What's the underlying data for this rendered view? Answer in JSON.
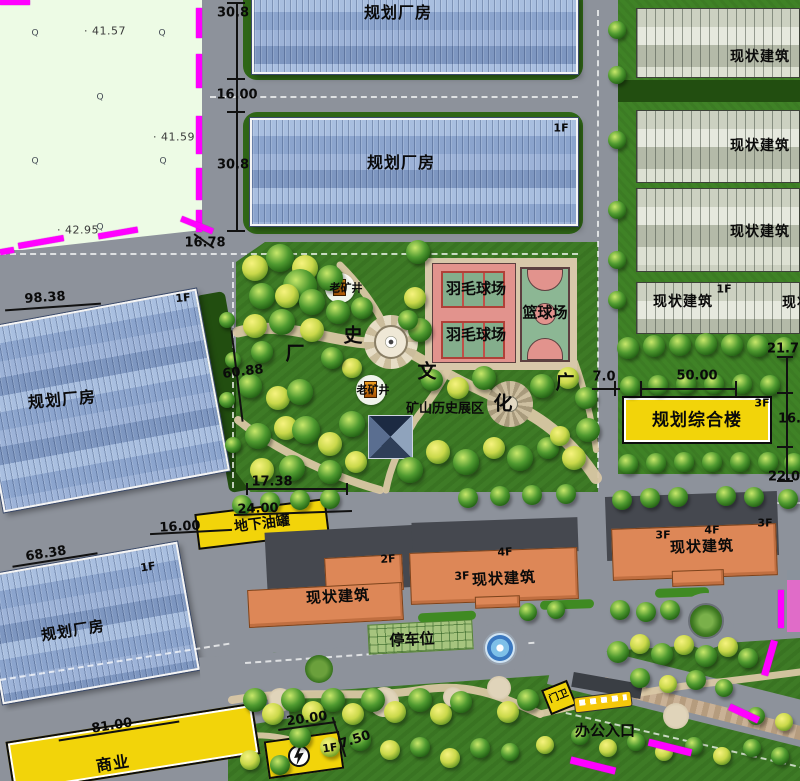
{
  "colors": {
    "boundary_magenta": "#ff00ff",
    "planned_factory_blue": "#8fa8cf",
    "existing_building_stripe": "#cdd2c2",
    "existing_building_orange": "#dd8757",
    "highlight_yellow": "#f2d40a",
    "park_green": "#3e7b26",
    "field_green": "#edfbe5",
    "road_gray": "#8d929b",
    "court_pink": "#e2938d",
    "court_green": "#84ae8c",
    "path_tan": "#d9c7a4"
  },
  "building_labels": [
    {
      "t": "规划厂房",
      "x": 398,
      "y": 13,
      "fs": 16
    },
    {
      "t": "规划厂房",
      "x": 401,
      "y": 163,
      "fs": 16
    },
    {
      "t": "规划厂房",
      "x": 62,
      "y": 400,
      "fs": 16,
      "r": -5
    },
    {
      "t": "规划厂房",
      "x": 73,
      "y": 631,
      "fs": 15,
      "r": -9
    },
    {
      "t": "现状建筑",
      "x": 760,
      "y": 57,
      "fs": 14
    },
    {
      "t": "现状建筑",
      "x": 760,
      "y": 146,
      "fs": 14
    },
    {
      "t": "现状建筑",
      "x": 760,
      "y": 232,
      "fs": 14
    },
    {
      "t": "现状建筑",
      "x": 683,
      "y": 302,
      "fs": 14
    },
    {
      "t": "现状建筑",
      "x": 812,
      "y": 303,
      "fs": 14
    },
    {
      "t": "规划综合楼",
      "x": 697,
      "y": 421,
      "fs": 17
    },
    {
      "t": "现状建筑",
      "x": 338,
      "y": 597,
      "fs": 15,
      "r": -3
    },
    {
      "t": "现状建筑",
      "x": 504,
      "y": 579,
      "fs": 15,
      "r": -3
    },
    {
      "t": "现状建筑",
      "x": 702,
      "y": 547,
      "fs": 15,
      "r": -2
    },
    {
      "t": "商业",
      "x": 113,
      "y": 764,
      "fs": 16,
      "r": -9
    }
  ],
  "floor_tags": [
    {
      "t": "1F",
      "x": 561,
      "y": 128
    },
    {
      "t": "1F",
      "x": 183,
      "y": 298,
      "r": -5
    },
    {
      "t": "1F",
      "x": 148,
      "y": 567,
      "r": -9
    },
    {
      "t": "1F",
      "x": 724,
      "y": 289
    },
    {
      "t": "3F",
      "x": 762,
      "y": 403
    },
    {
      "t": "2F",
      "x": 388,
      "y": 559,
      "r": -3
    },
    {
      "t": "3F",
      "x": 462,
      "y": 576,
      "r": -3
    },
    {
      "t": "4F",
      "x": 505,
      "y": 552,
      "r": -3
    },
    {
      "t": "3F",
      "x": 663,
      "y": 535
    },
    {
      "t": "4F",
      "x": 712,
      "y": 530
    },
    {
      "t": "3F",
      "x": 765,
      "y": 523
    },
    {
      "t": "1F",
      "x": 330,
      "y": 748,
      "r": -8
    }
  ],
  "dimension_labels": [
    {
      "t": "30.8",
      "x": 233,
      "y": 13
    },
    {
      "t": "16.00",
      "x": 237,
      "y": 95
    },
    {
      "t": "30.8",
      "x": 233,
      "y": 165
    },
    {
      "t": "16.78",
      "x": 205,
      "y": 243
    },
    {
      "t": "98.38",
      "x": 45,
      "y": 298,
      "r": -4
    },
    {
      "t": "60.88",
      "x": 243,
      "y": 372,
      "r": -7
    },
    {
      "t": "68.38",
      "x": 46,
      "y": 554,
      "r": -9
    },
    {
      "t": "81.00",
      "x": 112,
      "y": 726,
      "r": -9
    },
    {
      "t": "17.38",
      "x": 272,
      "y": 482
    },
    {
      "t": "24.00",
      "x": 258,
      "y": 509,
      "r": -2
    },
    {
      "t": "16.00",
      "x": 180,
      "y": 527,
      "r": -3
    },
    {
      "t": "7.0",
      "x": 604,
      "y": 377
    },
    {
      "t": "50.00",
      "x": 697,
      "y": 376
    },
    {
      "t": "21.7",
      "x": 783,
      "y": 349
    },
    {
      "t": "16.0",
      "x": 794,
      "y": 419
    },
    {
      "t": "22.0",
      "x": 784,
      "y": 477
    },
    {
      "t": "20.00",
      "x": 307,
      "y": 719,
      "r": -8
    },
    {
      "t": "7.50",
      "x": 355,
      "y": 740,
      "r": -18
    }
  ],
  "elevation_labels": [
    {
      "t": "· 41.57",
      "x": 105,
      "y": 31
    },
    {
      "t": "· 41.59",
      "x": 174,
      "y": 137
    },
    {
      "t": "· 42.95",
      "x": 78,
      "y": 230
    }
  ],
  "feature_labels": [
    {
      "t": "羽毛球场",
      "x": 476,
      "y": 289,
      "fs": 15
    },
    {
      "t": "羽毛球场",
      "x": 476,
      "y": 335,
      "fs": 15
    },
    {
      "t": "篮球场",
      "x": 545,
      "y": 313,
      "fs": 15
    },
    {
      "t": "地下油罐",
      "x": 262,
      "y": 524,
      "fs": 14,
      "r": -7
    },
    {
      "t": "停车位",
      "x": 412,
      "y": 640,
      "fs": 15,
      "r": -3
    },
    {
      "t": "办公入口",
      "x": 605,
      "y": 731,
      "fs": 15
    },
    {
      "t": "门卫",
      "x": 559,
      "y": 697,
      "fs": 10,
      "r": -22
    },
    {
      "t": "老矿井",
      "x": 346,
      "y": 288,
      "fs": 11
    },
    {
      "t": "老矿井",
      "x": 373,
      "y": 390,
      "fs": 11
    },
    {
      "t": "矿山历史展区",
      "x": 445,
      "y": 409,
      "fs": 13
    }
  ],
  "scattered_characters": [
    {
      "t": "厂",
      "x": 295,
      "y": 354
    },
    {
      "t": "史",
      "x": 353,
      "y": 336
    },
    {
      "t": "文",
      "x": 427,
      "y": 372
    },
    {
      "t": "化",
      "x": 503,
      "y": 404
    },
    {
      "t": "广",
      "x": 565,
      "y": 383
    }
  ],
  "survey_marks": [
    {
      "t": "Q",
      "x": 35,
      "y": 34
    },
    {
      "t": "Q",
      "x": 162,
      "y": 34
    },
    {
      "t": "Q",
      "x": 100,
      "y": 98
    },
    {
      "t": "Q",
      "x": 35,
      "y": 162
    },
    {
      "t": "Q",
      "x": 163,
      "y": 162
    },
    {
      "t": "Q",
      "x": 100,
      "y": 228
    }
  ]
}
